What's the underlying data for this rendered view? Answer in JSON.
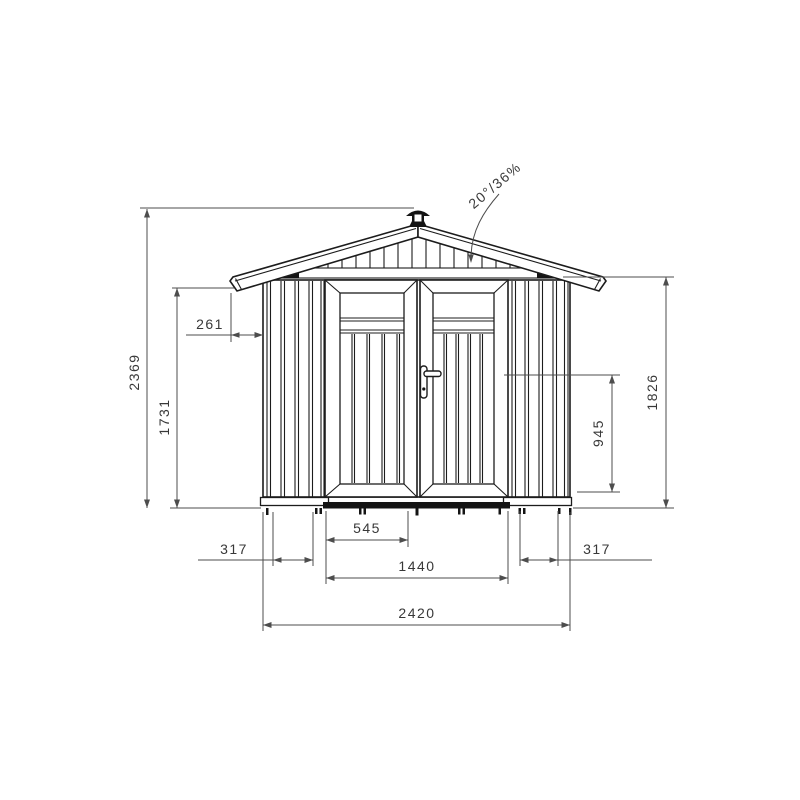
{
  "drawing": {
    "type": "technical-elevation",
    "subject": "garden shed front elevation with dimensions",
    "background_color": "#ffffff",
    "line_color": "#1c1c1c",
    "dimension_color": "#4d4d4d",
    "roof_pitch_label": "20°/36%",
    "dimensions": {
      "overall_height": "2369",
      "eave_height": "1731",
      "roof_overhang": "261",
      "right_wall_height": "1826",
      "handle_height": "945",
      "door_leaf_width": "545",
      "door_opening_width": "1440",
      "left_panel_width": "317",
      "right_panel_width": "317",
      "overall_width": "2420"
    }
  }
}
